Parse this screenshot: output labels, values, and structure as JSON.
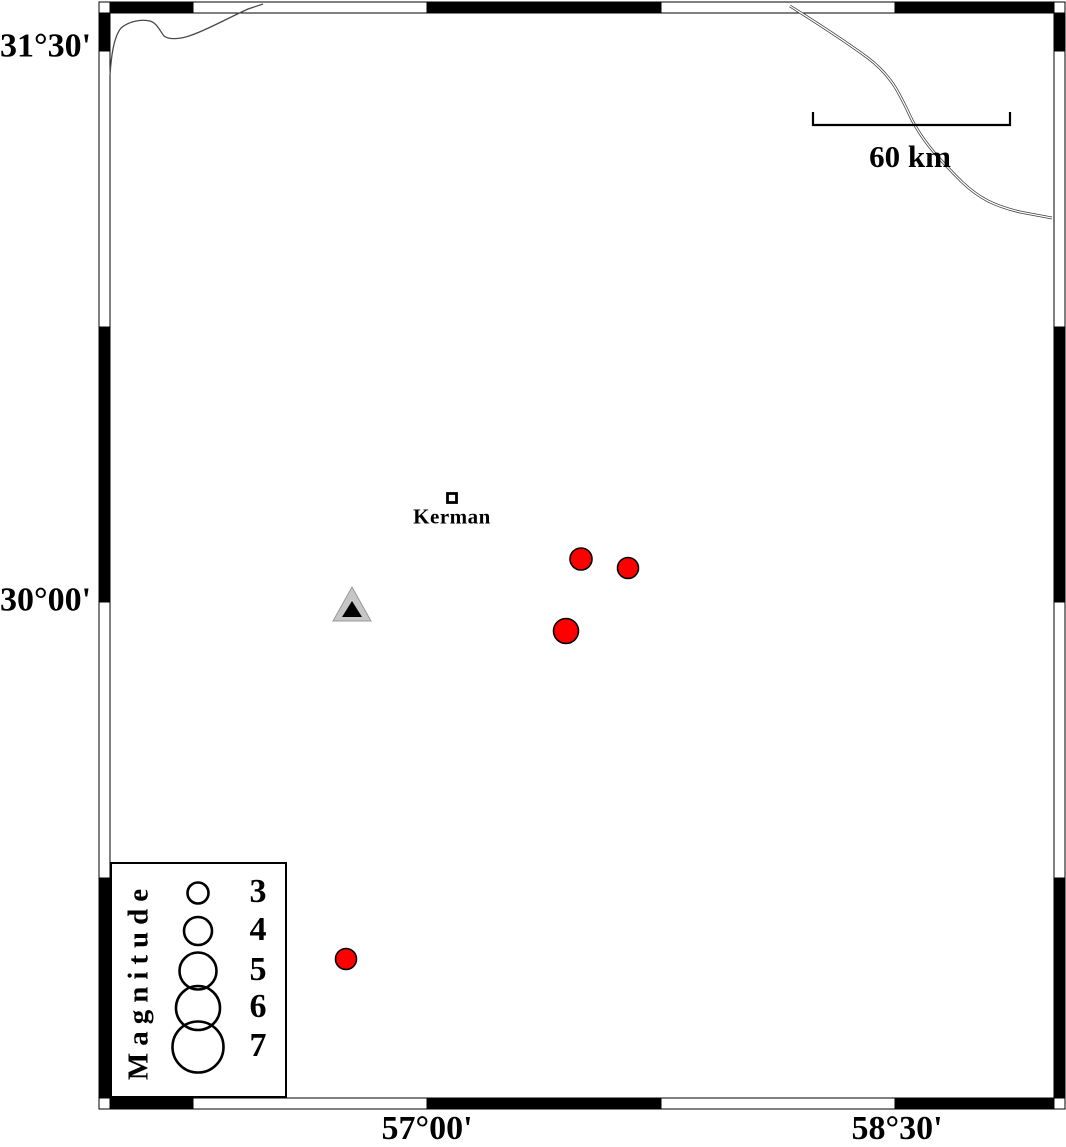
{
  "frame_labels": {
    "lat": [
      {
        "text": "31°30'",
        "y": 48
      },
      {
        "text": "30°00'",
        "y": 602
      }
    ],
    "lon": [
      {
        "text": "57°00'",
        "x": 427
      },
      {
        "text": "58°30'",
        "x": 897
      }
    ]
  },
  "scale_bar": {
    "label": "60 km",
    "x1": 813,
    "x2": 1010,
    "y": 125
  },
  "city_marker": {
    "label": "Kerman",
    "x": 452,
    "y": 498
  },
  "station_marker": {
    "x": 352,
    "y": 604,
    "fill": "#c6c6c6",
    "inner_fill": "#000000"
  },
  "earthquake_color": "#ff0000",
  "earthquakes": [
    {
      "x": 581,
      "y": 559,
      "r": 11
    },
    {
      "x": 628,
      "y": 568,
      "r": 10.5
    },
    {
      "x": 566,
      "y": 631,
      "r": 12.5
    },
    {
      "x": 346,
      "y": 959,
      "r": 10.5
    }
  ],
  "legend": {
    "title": "Magnitude",
    "circle_x": 198,
    "entries": [
      {
        "label": "3",
        "cy": 893,
        "r": 10.5
      },
      {
        "label": "4",
        "cy": 931,
        "r": 14
      },
      {
        "label": "5",
        "cy": 971,
        "r": 18.5
      },
      {
        "label": "6",
        "cy": 1008,
        "r": 22
      },
      {
        "label": "7",
        "cy": 1047,
        "r": 25.5
      }
    ]
  }
}
